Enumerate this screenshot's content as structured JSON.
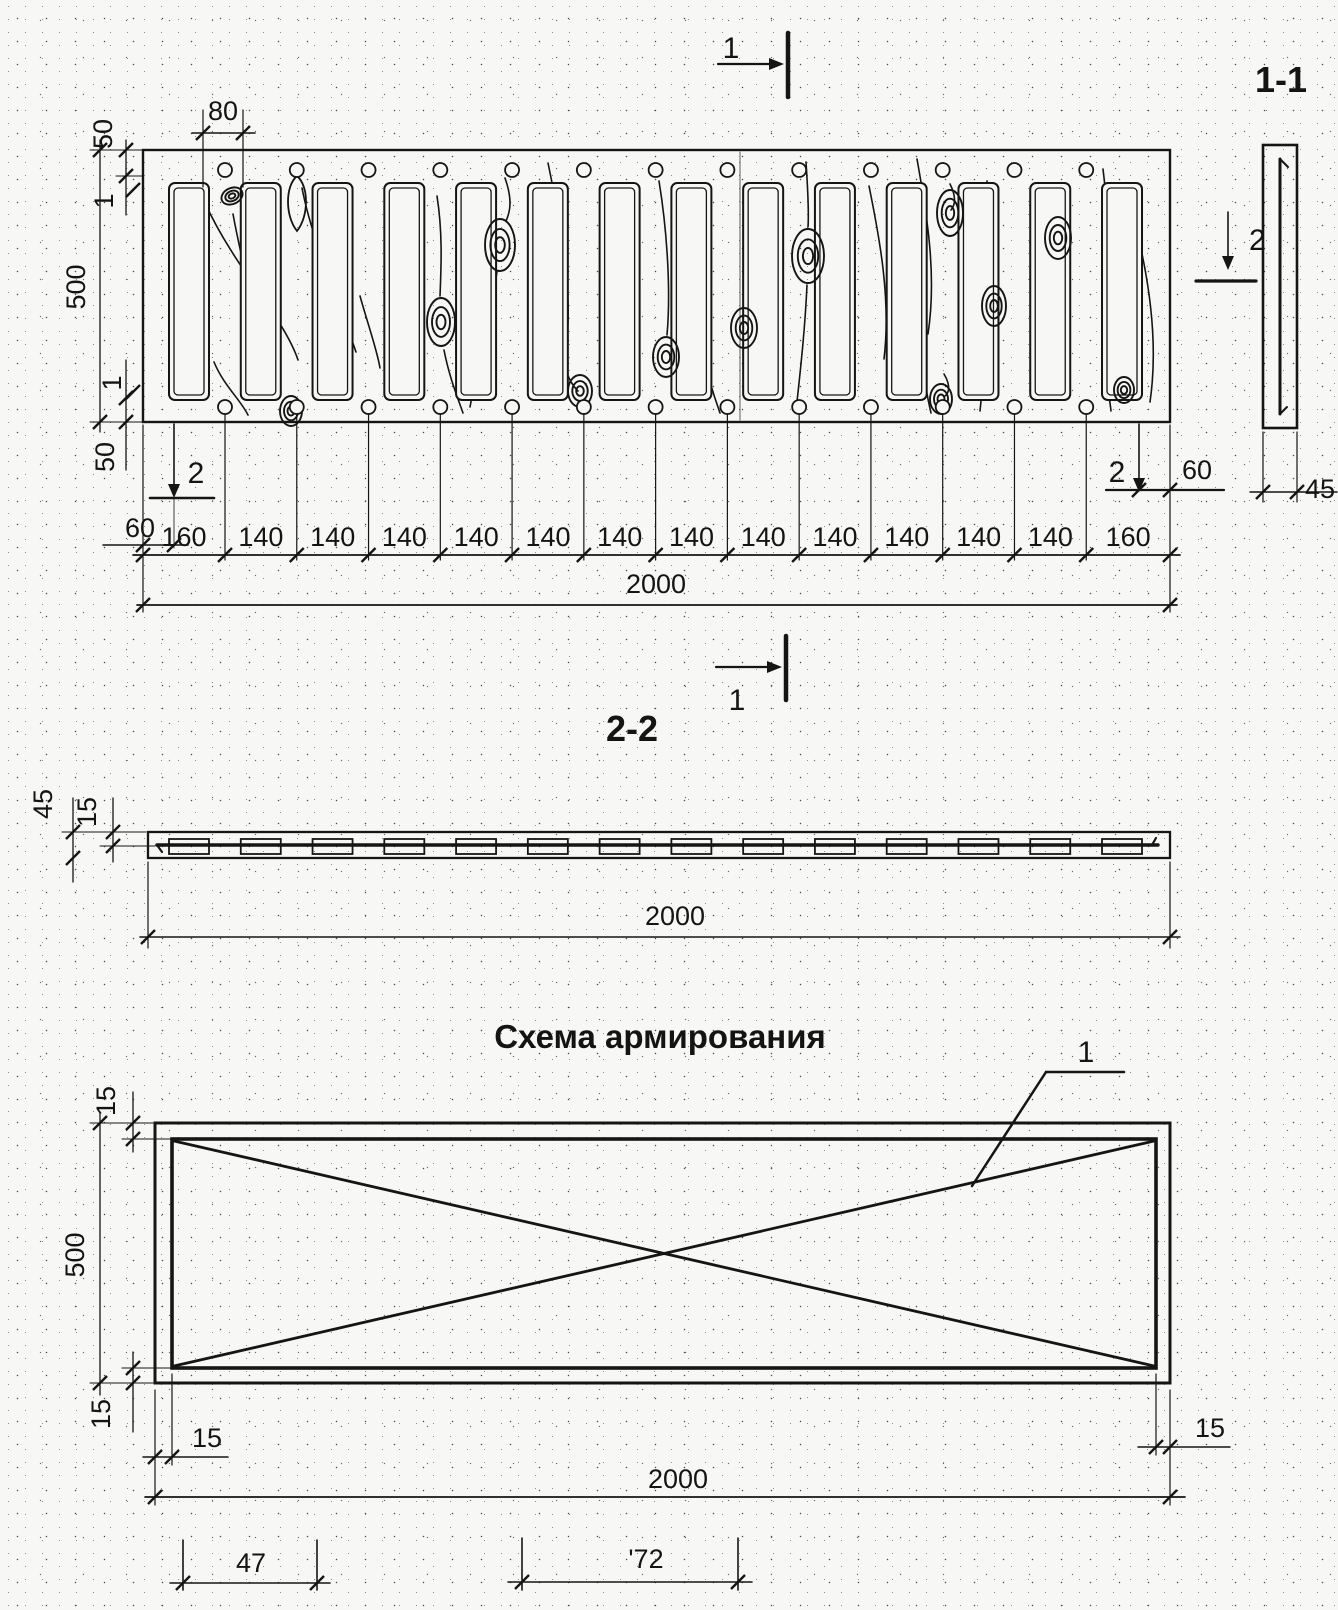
{
  "section_marks": {
    "mark_1": "1",
    "mark_2": "2"
  },
  "plan": {
    "dim_top_margin": "50",
    "dim_slot_width": "80",
    "dim_height": "500",
    "dim_hairline": "1",
    "dim_bottom_margin": "50",
    "dim_edge_offset_left": "60",
    "dim_edge_offset_right": "60",
    "chain": [
      "160",
      "140",
      "140",
      "140",
      "140",
      "140",
      "140",
      "140",
      "140",
      "140",
      "140",
      "140",
      "140",
      "160"
    ],
    "dim_overall": "2000"
  },
  "section_11": {
    "title": "1-1",
    "dim_width": "45"
  },
  "section_22": {
    "title": "2-2",
    "dim_thickness": "45",
    "dim_cover": "15",
    "dim_overall": "2000"
  },
  "scheme": {
    "title": "Схема армирования",
    "callout": "1",
    "dim_cover_top": "15",
    "dim_height": "500",
    "dim_cover_bottom": "15",
    "dim_cover_left": "15",
    "dim_cover_right": "15",
    "dim_overall": "2000",
    "dim_bar_a": "47",
    "dim_bar_b": "'72"
  }
}
